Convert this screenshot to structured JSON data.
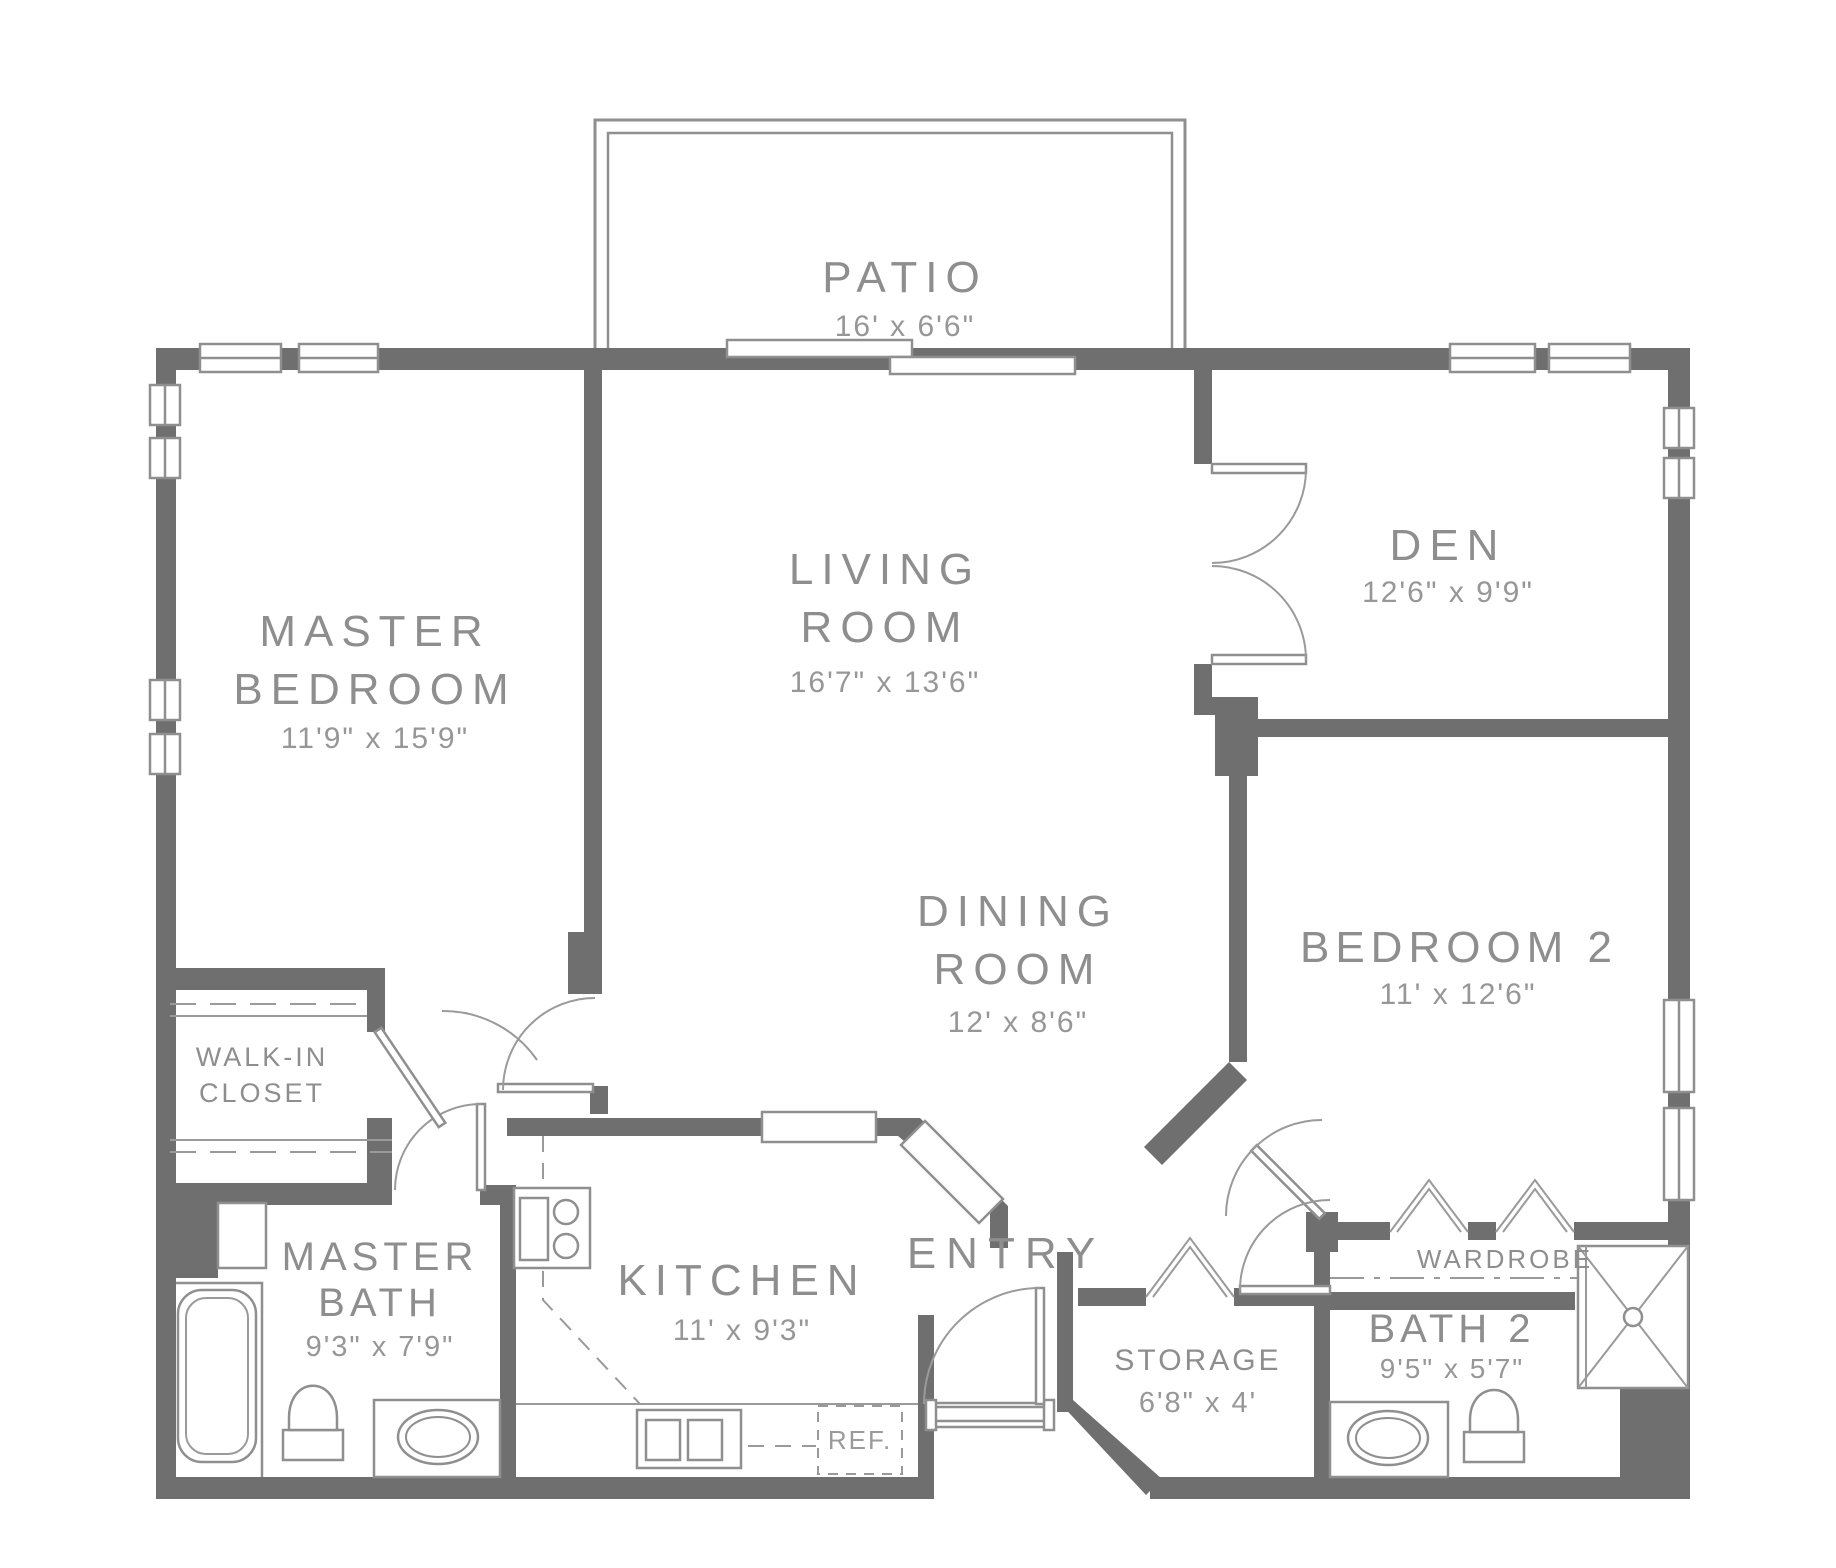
{
  "colors": {
    "wall": "#6f6f6f",
    "line": "#8f8f8f",
    "text": "#8e8e8e",
    "background": "#ffffff"
  },
  "rooms": {
    "patio": {
      "name": "PATIO",
      "dims": "16' x 6'6\""
    },
    "master_bedroom": {
      "name_line1": "MASTER",
      "name_line2": "BEDROOM",
      "dims": "11'9\" x 15'9\""
    },
    "living_room": {
      "name_line1": "LIVING",
      "name_line2": "ROOM",
      "dims": "16'7\" x 13'6\""
    },
    "den": {
      "name": "DEN",
      "dims": "12'6\" x 9'9\""
    },
    "dining_room": {
      "name_line1": "DINING",
      "name_line2": "ROOM",
      "dims": "12' x 8'6\""
    },
    "bedroom_2": {
      "name": "BEDROOM 2",
      "dims": "11' x 12'6\""
    },
    "walk_in_closet": {
      "name_line1": "WALK-IN",
      "name_line2": "CLOSET"
    },
    "master_bath": {
      "name_line1": "MASTER",
      "name_line2": "BATH",
      "dims": "9'3\" x 7'9\""
    },
    "kitchen": {
      "name": "KITCHEN",
      "dims": "11' x 9'3\""
    },
    "entry": {
      "name": "ENTRY"
    },
    "storage": {
      "name": "STORAGE",
      "dims": "6'8\" x 4'"
    },
    "bath_2": {
      "name": "BATH 2",
      "dims": "9'5\" x 5'7\""
    },
    "wardrobe": {
      "name": "WARDROBE"
    },
    "refrigerator": {
      "name": "REF."
    }
  }
}
